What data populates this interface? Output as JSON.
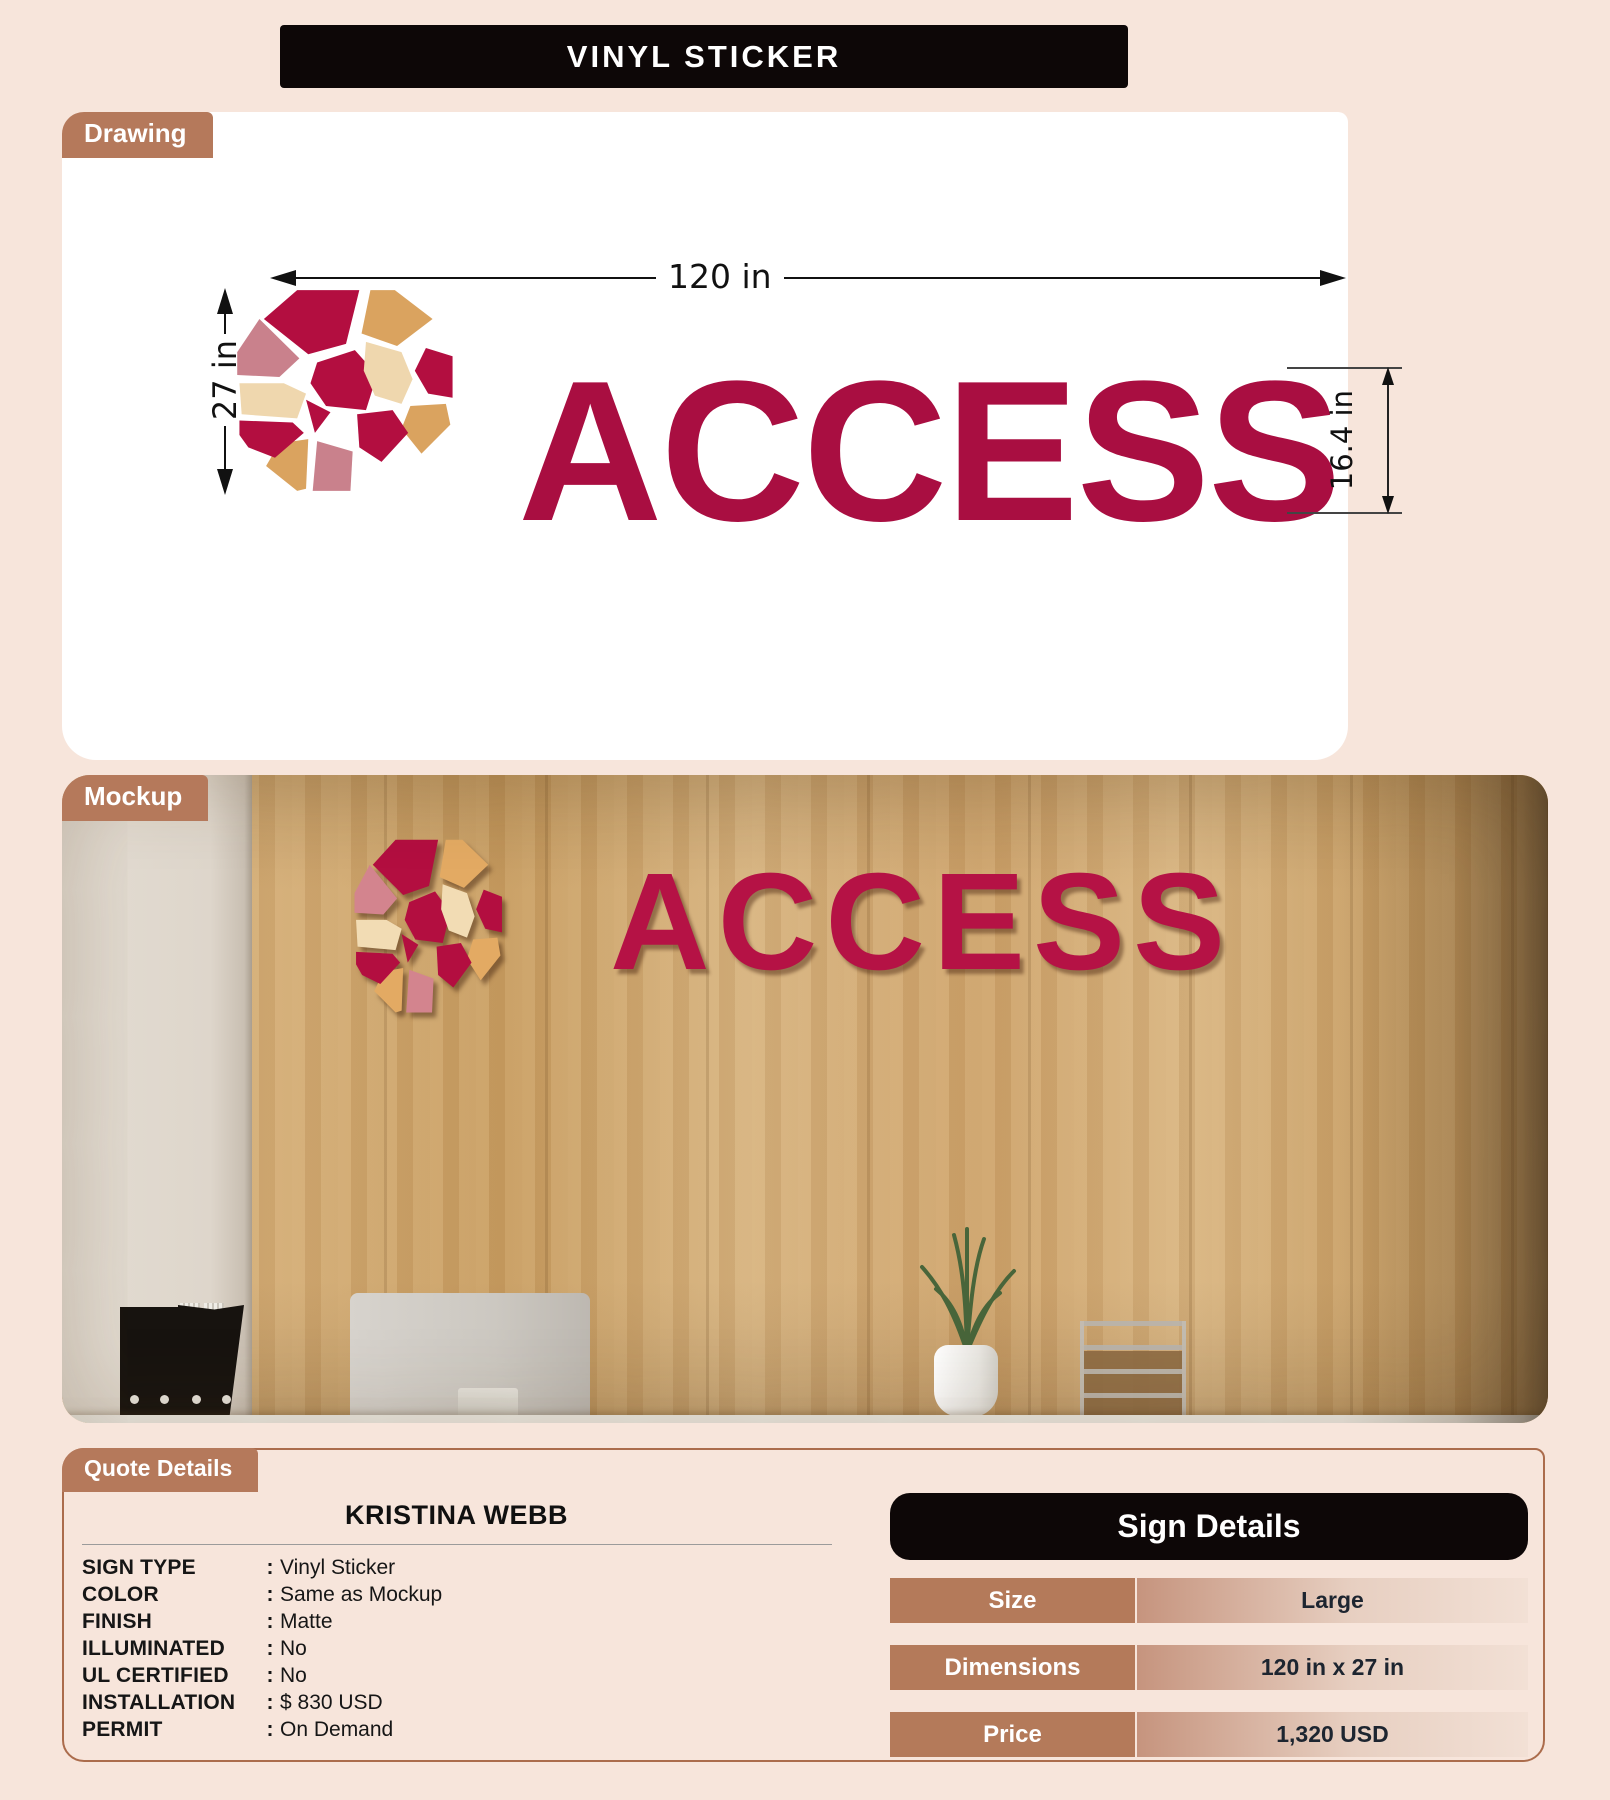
{
  "title": "VINYL STICKER",
  "drawing": {
    "tab": "Drawing",
    "logo_text": "ACCESS",
    "width_label": "120 in",
    "height_label": "27 in",
    "text_height_label": "16.4 in"
  },
  "mockup": {
    "tab": "Mockup",
    "logo_text": "ACCESS"
  },
  "quote": {
    "tab": "Quote Details",
    "customer": "KRISTINA WEBB",
    "colon": ":",
    "rows": [
      {
        "label": "SIGN TYPE",
        "value": "Vinyl Sticker"
      },
      {
        "label": "COLOR",
        "value": "Same as Mockup"
      },
      {
        "label": "FINISH",
        "value": "Matte"
      },
      {
        "label": "ILLUMINATED",
        "value": "No"
      },
      {
        "label": "UL CERTIFIED",
        "value": "No"
      },
      {
        "label": "INSTALLATION",
        "value": "$ 830 USD"
      },
      {
        "label": "PERMIT",
        "value": "On Demand"
      }
    ]
  },
  "sign_details": {
    "header": "Sign Details",
    "rows": [
      {
        "label": "Size",
        "value": "Large"
      },
      {
        "label": "Dimensions",
        "value": "120 in x 27 in"
      },
      {
        "label": "Price",
        "value": "1,320 USD"
      }
    ]
  },
  "colors": {
    "page_background": "#f7e5db",
    "accent_sienna": "#b5795b",
    "header_black": "#0d0707",
    "logo_crimson": "#a90e41",
    "logo_rose": "#c9818c",
    "logo_tan": "#daa35f",
    "logo_cream": "#efd7ae",
    "value_text_dark": "#1d2530"
  }
}
